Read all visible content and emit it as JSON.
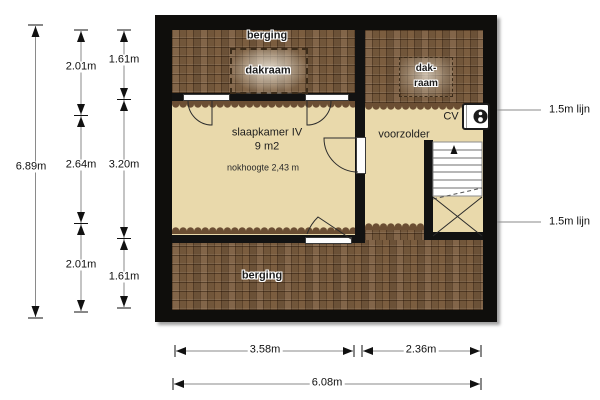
{
  "plan_type": "floor-plan-attic",
  "rooms": {
    "berging_top": "berging",
    "dakraam_top": "dakraam",
    "dakraam_right_line1": "dak-",
    "dakraam_right_line2": "raam",
    "slaapkamer_title": "slaapkamer IV",
    "slaapkamer_area": "9 m2",
    "slaapkamer_note": "nokhoogte 2,43 m",
    "voorzolder": "voorzolder",
    "cv": "CV",
    "berging_bottom": "berging"
  },
  "dims": {
    "total_height": "6.89m",
    "col_a": [
      "2.01m",
      "2.64m",
      "2.01m"
    ],
    "col_b": [
      "1.61m",
      "3.20m",
      "1.61m"
    ],
    "bottom_left": "3.58m",
    "bottom_right": "2.36m",
    "bottom_total": "6.08m",
    "right_lines": [
      "1.5m lijn",
      "1.5m lijn"
    ]
  },
  "colors": {
    "wall": "#0f0e0c",
    "roof_tiles": "#7b5d3f",
    "floor": "#e9d9ab",
    "dim_line": "#8a8a8a"
  }
}
